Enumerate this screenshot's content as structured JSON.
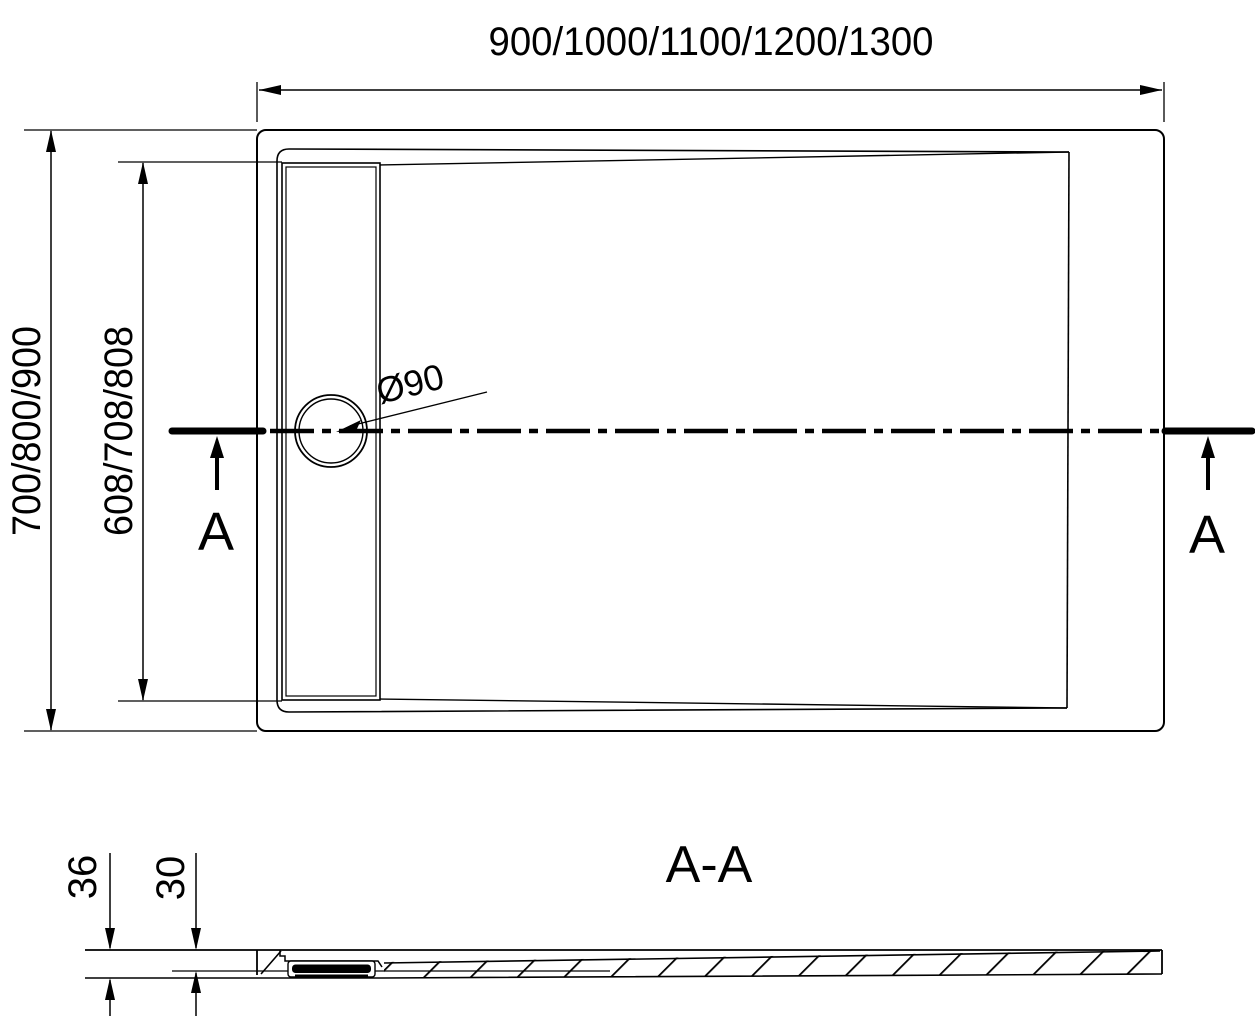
{
  "colors": {
    "line": "#000000",
    "background": "#ffffff"
  },
  "top_view": {
    "width_dim_label": "900/1000/1100/1200/1300",
    "outer_depth_dim_label": "700/800/900",
    "drain_length_dim_label": "608/708/808",
    "drain_diameter_label": "Ø90",
    "section_arrow_left_label": "A",
    "section_arrow_right_label": "A"
  },
  "section_view": {
    "title": "A-A",
    "overall_height_dim_label": "36",
    "basin_depth_dim_label": "30"
  }
}
